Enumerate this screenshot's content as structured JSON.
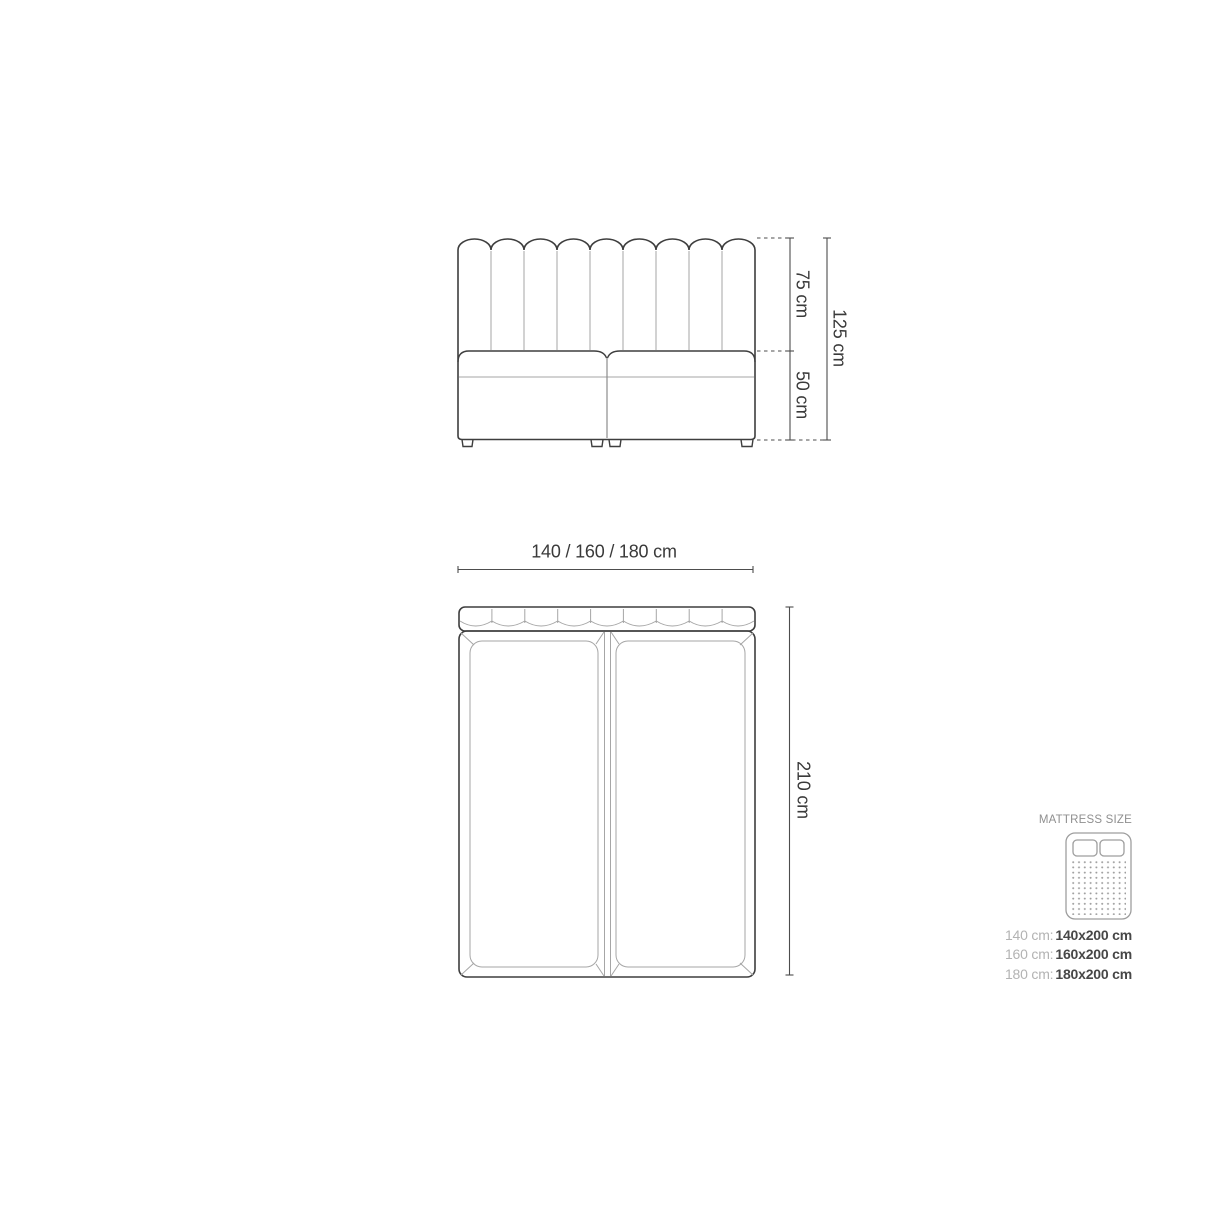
{
  "front_view": {
    "headboard_height_label": "75 cm",
    "base_height_label": "50 cm",
    "total_height_label": "125 cm"
  },
  "plan_view": {
    "width_label": "140 / 160 / 180 cm",
    "length_label": "210 cm"
  },
  "legend": {
    "title": "MATTRESS SIZE",
    "icon": "mattress-top-view-icon",
    "rows": [
      {
        "label": "140 cm:",
        "value": "140x200 cm"
      },
      {
        "label": "160 cm:",
        "value": "160x200 cm"
      },
      {
        "label": "180 cm:",
        "value": "180x200 cm"
      }
    ]
  },
  "colors": {
    "outline_dark": "#3e3e3e",
    "outline_light": "#a6a6a6",
    "outline_medium": "#8c8c8c",
    "dimension_line": "#4d4d4d",
    "label_text": "#3a3a3a",
    "legend_title": "#8f8f8f",
    "legend_label": "#b3b3b3",
    "legend_value": "#474747",
    "background": "#ffffff"
  }
}
